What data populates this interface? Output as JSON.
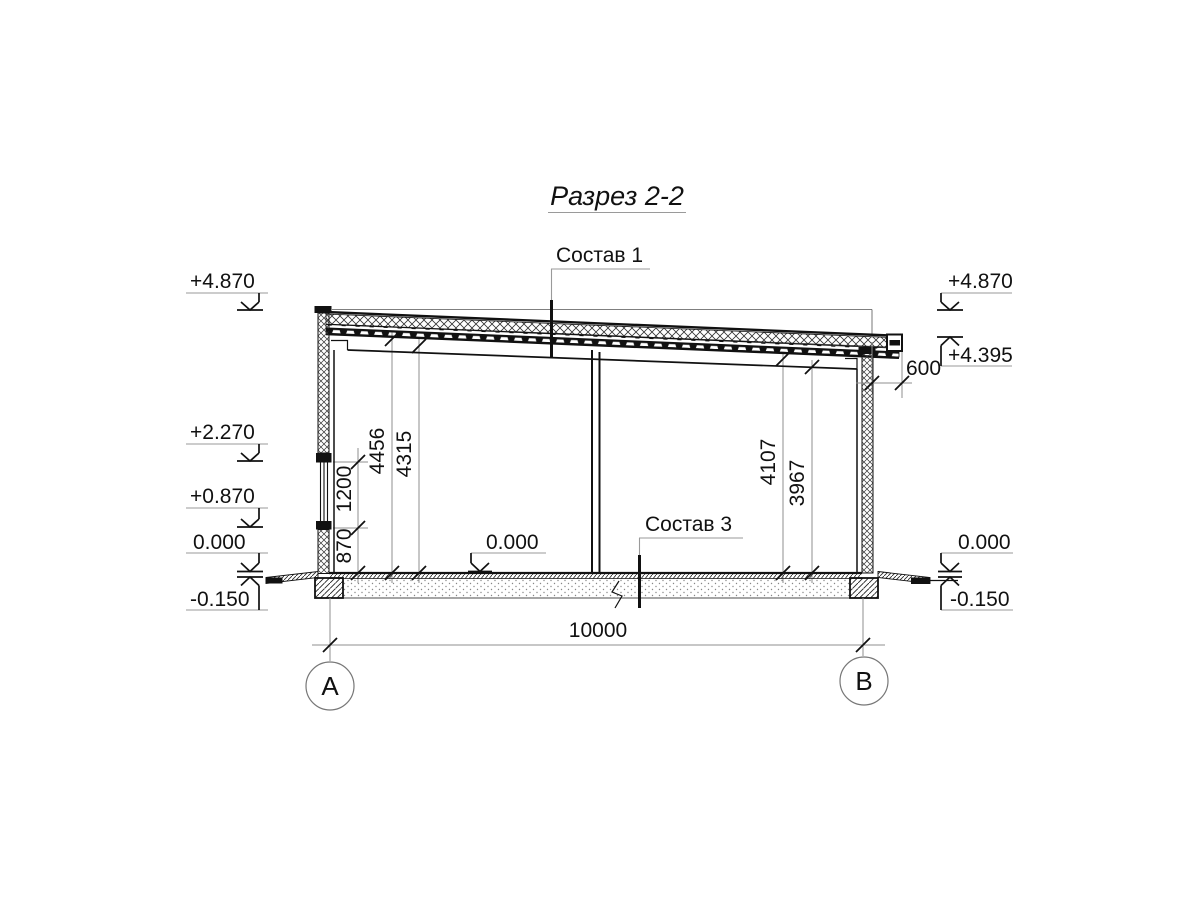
{
  "title": "Разрез 2-2",
  "callouts": {
    "roof": "Состав 1",
    "floor": "Состав 3"
  },
  "elevations": {
    "left": [
      "+4.870",
      "+2.270",
      "+0.870",
      "0.000",
      "-0.150"
    ],
    "right": [
      "+4.870",
      "+4.395",
      "0.000",
      "-0.150"
    ],
    "floor_inner": "0.000"
  },
  "dimensions": {
    "overall_width": "10000",
    "roof_overhang": "600",
    "left_height_to_deck": "4456",
    "left_height_to_beam": "4315",
    "window_sill_height": "870",
    "window_height": "1200",
    "right_height_to_deck": "4107",
    "right_height_to_beam": "3967"
  },
  "axes": {
    "left": "А",
    "right": "В"
  },
  "colors": {
    "ink": "#111111",
    "aux_gray": "#8f8f8f",
    "paper": "#ffffff"
  }
}
